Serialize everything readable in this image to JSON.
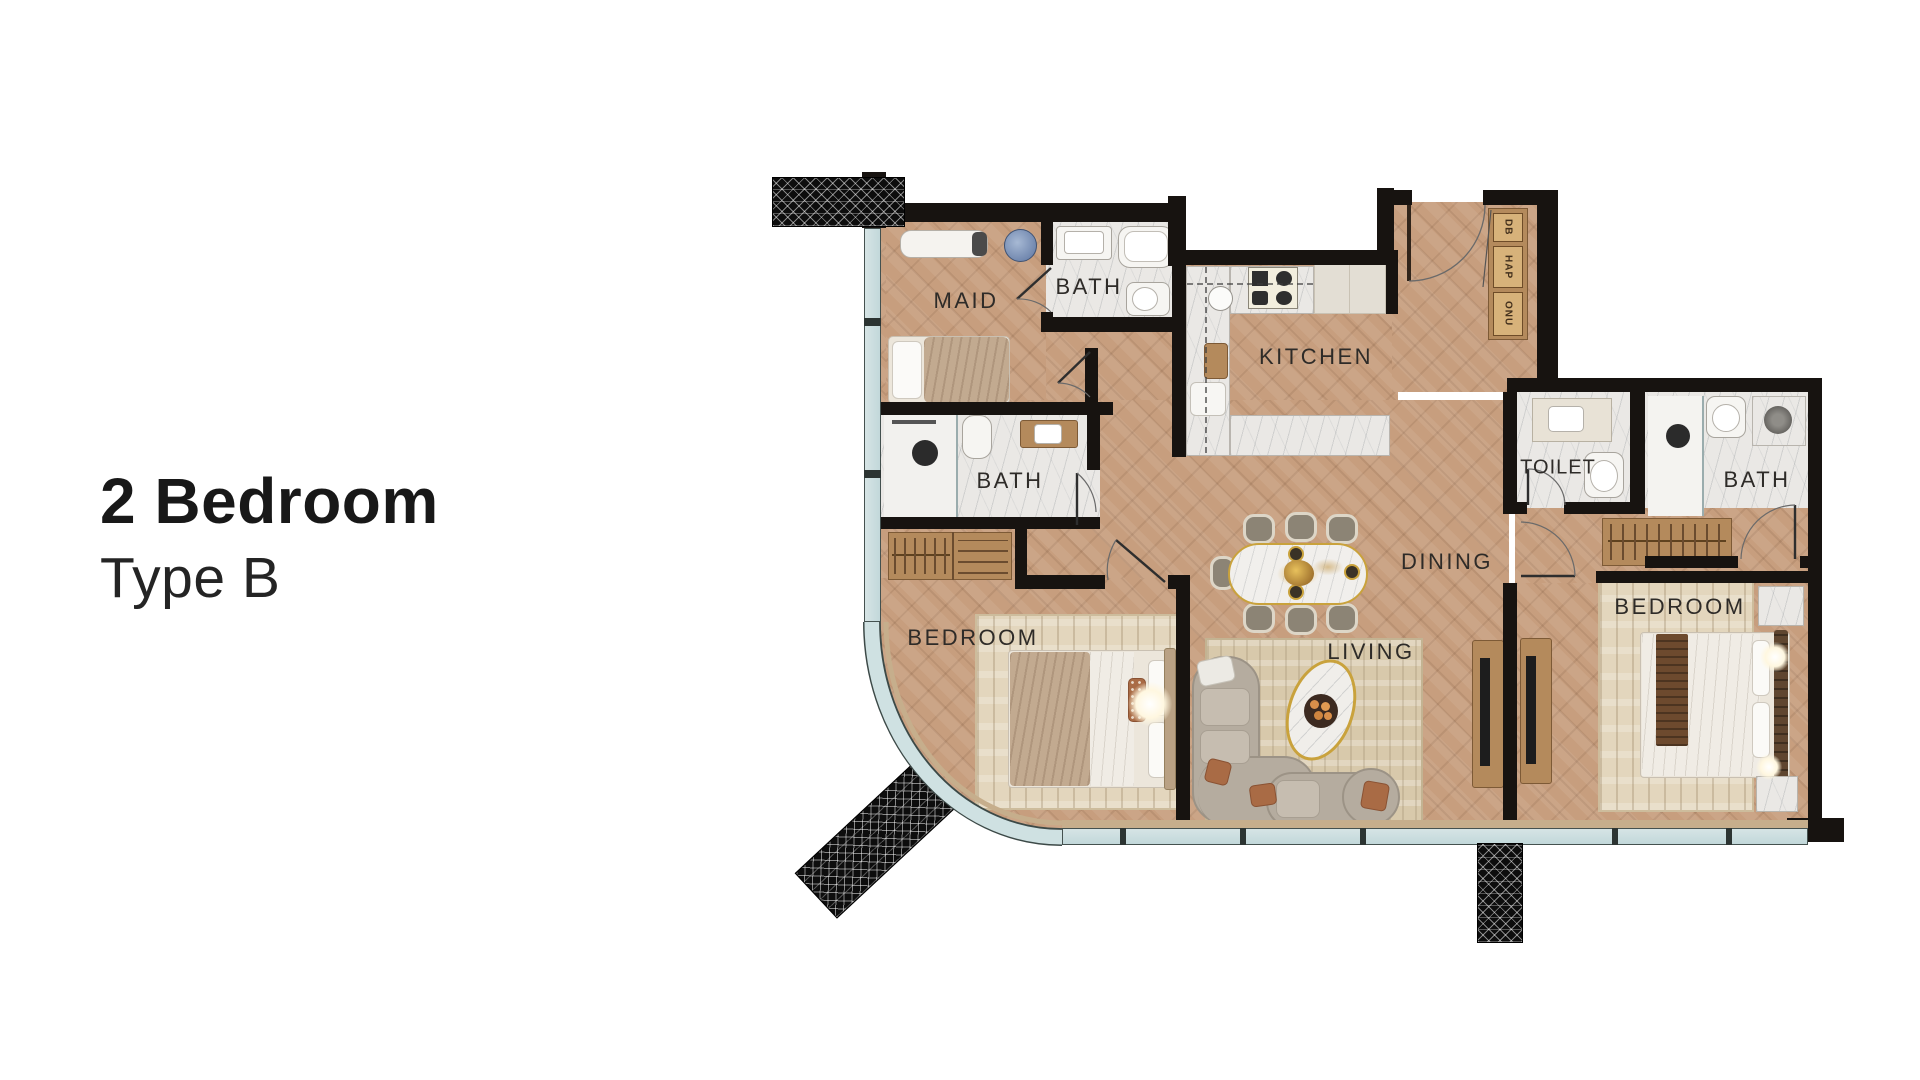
{
  "title": {
    "heading": "2 Bedroom",
    "subheading": "Type B"
  },
  "floorplan": {
    "room_labels": [
      {
        "id": "maid",
        "label": "MAID"
      },
      {
        "id": "bath-1",
        "label": "BATH"
      },
      {
        "id": "kitchen",
        "label": "KITCHEN"
      },
      {
        "id": "bath-2",
        "label": "BATH"
      },
      {
        "id": "toilet",
        "label": "TOILET"
      },
      {
        "id": "bath-3",
        "label": "BATH"
      },
      {
        "id": "dining",
        "label": "DINING"
      },
      {
        "id": "bedroom-1",
        "label": "BEDROOM"
      },
      {
        "id": "living",
        "label": "LIVING"
      },
      {
        "id": "bedroom-2",
        "label": "BEDROOM"
      }
    ],
    "closet_labels": [
      "DB",
      "HAP",
      "ONU"
    ],
    "colors": {
      "wall": "#171310",
      "wood_floor": "#c79e7e",
      "marble_floor": "#eae8e5",
      "glass": "#c9dddf",
      "hatch": "#0d0d0d",
      "label_text": "#2e2b28",
      "furniture_wood": "#b48a5c",
      "accent_rust": "#a96b45",
      "title_text": "#181818"
    }
  }
}
